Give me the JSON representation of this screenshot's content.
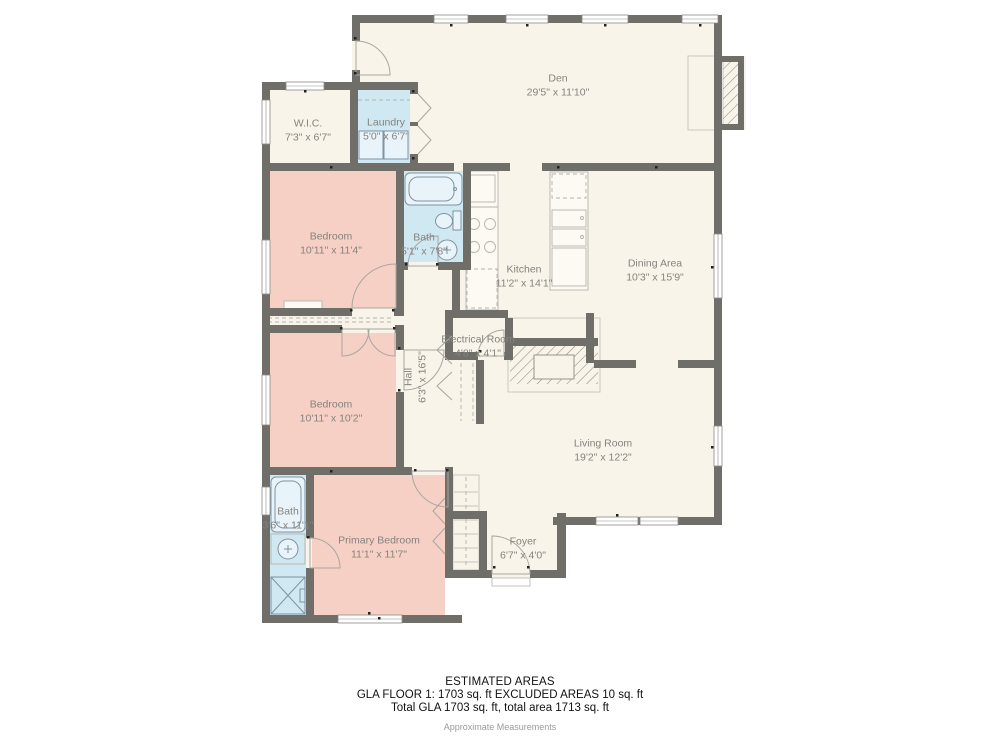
{
  "plan": {
    "rooms": [
      {
        "name": "Den",
        "dims": "29'5\" x 11'10\""
      },
      {
        "name": "W.I.C.",
        "dims": "7'3\" x 6'7\""
      },
      {
        "name": "Laundry",
        "dims": "5'0\" x 6'7\""
      },
      {
        "name": "Bedroom",
        "dims": "10'11\" x 11'4\""
      },
      {
        "name": "Bath",
        "dims": "5'1\" x 7'8\""
      },
      {
        "name": "Kitchen",
        "dims": "11'2\" x 14'1\""
      },
      {
        "name": "Dining Area",
        "dims": "10'3\" x 15'9\""
      },
      {
        "name": "Electrical Room",
        "dims": "4'8\" x 4'1\""
      },
      {
        "name": "Hall",
        "dims": "6'3\" x 16'5\""
      },
      {
        "name": "Bedroom",
        "dims": "10'11\" x 10'2\""
      },
      {
        "name": "Living Room",
        "dims": "19'2\" x 12'2\""
      },
      {
        "name": "Bath",
        "dims": "3'6\" x 11'1\""
      },
      {
        "name": "Primary Bedroom",
        "dims": "11'1\" x 11'7\""
      },
      {
        "name": "Foyer",
        "dims": "6'7\" x 4'0\""
      }
    ],
    "footer": {
      "title": "ESTIMATED AREAS",
      "line1": "GLA FLOOR 1: 1703 sq. ft EXCLUDED AREAS 10 sq. ft",
      "line2": "Total GLA 1703 sq. ft, total area 1713 sq. ft",
      "note": "Approximate Measurements"
    },
    "colors": {
      "wall": "#706e69",
      "floor": "#f8f4ea",
      "bedroom_fill": "#f6d0c5",
      "wet_room_fill": "#cfe8f2",
      "label_text": "#85837e"
    }
  }
}
